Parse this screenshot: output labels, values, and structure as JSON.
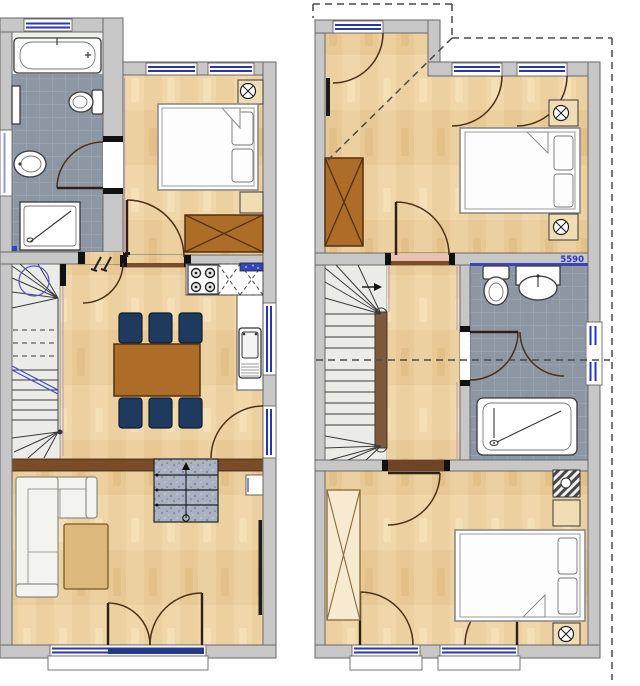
{
  "document": {
    "type": "architectural-floor-plan",
    "views": [
      "ground-floor",
      "upper-floor"
    ]
  },
  "labels": {
    "bathroom_dimension": "5590"
  },
  "colors": {
    "wall": "#c7c7c7",
    "wall_edge": "#6a6a6a",
    "wood": "#ecd0a0",
    "wood_dark": "#e3c28f",
    "tile": "#8d97a4",
    "tile_line": "#a3adba",
    "stair": "#ebebe8",
    "fixture_white": "#ffffff",
    "outline": "#3a3a3a",
    "furniture_wood": "#ad6c28",
    "chair_navy": "#1e3a5e",
    "sofa": "#f3f3f0",
    "table_light": "#dcb87c",
    "granite": "#a9b2c2",
    "brown_band": "#7a4c28",
    "spine_brown": "#7d5a3e",
    "window_blue": "#2a35b0",
    "door_navy": "#223a8c",
    "label_blue": "#2b35c8",
    "dashed": "#4a4a4a",
    "threshold_pink": "#e7c0b0",
    "wardrobe_light": "#f7ead0",
    "nightstand": "#f0ddb4"
  }
}
